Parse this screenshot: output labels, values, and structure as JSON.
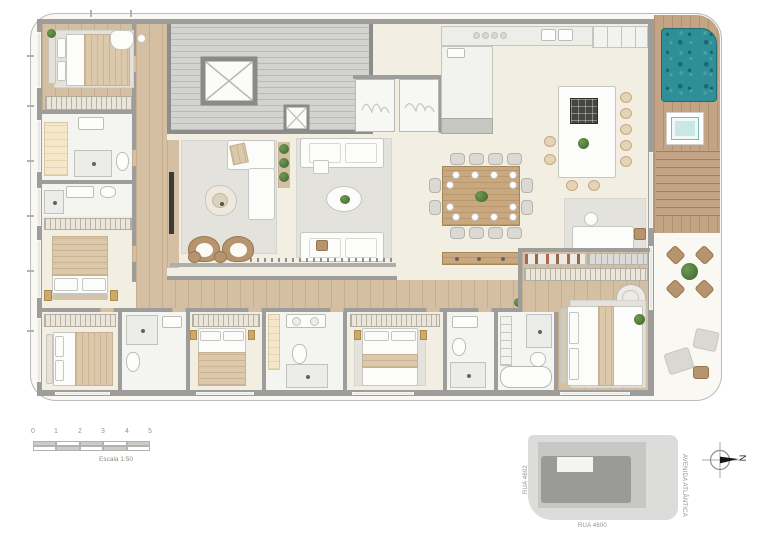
{
  "scalebar": {
    "ticks": [
      "0",
      "1",
      "2",
      "3",
      "4",
      "5"
    ],
    "caption": "Escala 1:50"
  },
  "keymap": {
    "street_left": "RUA 4602",
    "street_bottom": "RUA 4600",
    "street_right": "AVENIDA ATLÂNTICA"
  },
  "compass": {
    "label": "N"
  },
  "colors": {
    "pool": "#2e8f96",
    "spa": "#c9e7e4",
    "walls": "#9d9d9b",
    "wood_floor": "#d4bfa2",
    "deck_wood": "#c3a585",
    "floor_cream": "#f3eee2",
    "rug_gray": "#e3e2dd",
    "accent_tan": "#b6946e",
    "keymap_building": "#9a9a99"
  }
}
